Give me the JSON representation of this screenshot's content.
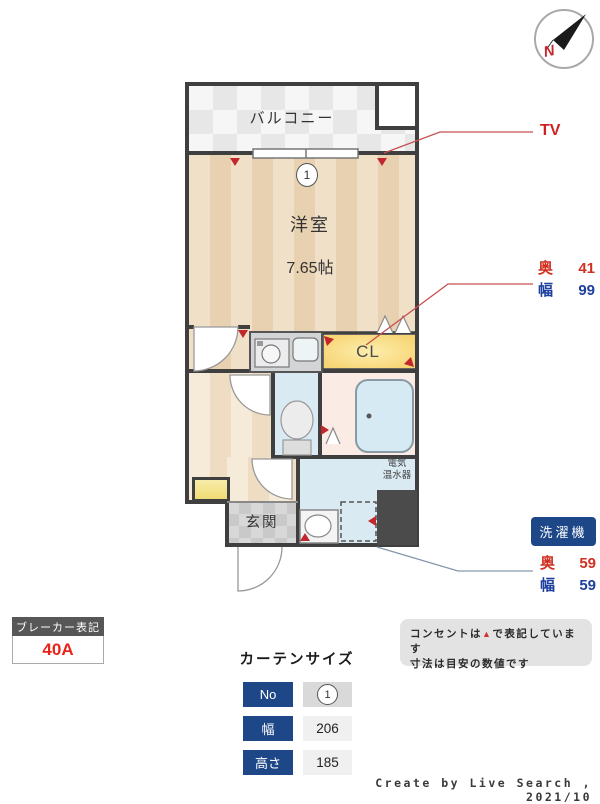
{
  "compass": {
    "north_label": "N"
  },
  "floorplan": {
    "balcony": "バルコニー",
    "room_name": "洋室",
    "room_size": "7.65帖",
    "window_no": "1",
    "closet": "CL",
    "entrance": "玄関",
    "water_heater_line1": "電気",
    "water_heater_line2": "温水器"
  },
  "annotations": {
    "tv": "TV",
    "closet_dims": {
      "rows": [
        {
          "label": "奥",
          "value": "41"
        },
        {
          "label": "幅",
          "value": "99"
        }
      ]
    },
    "washer": {
      "badge": "洗濯機",
      "rows": [
        {
          "label": "奥",
          "value": "59"
        },
        {
          "label": "幅",
          "value": "59"
        }
      ]
    }
  },
  "breaker": {
    "title": "ブレーカー表記",
    "value": "40A"
  },
  "curtain": {
    "title": "カーテンサイズ",
    "rows": [
      {
        "label": "No",
        "value": "1"
      },
      {
        "label": "幅",
        "value": "206"
      },
      {
        "label": "高さ",
        "value": "185"
      }
    ]
  },
  "notes": {
    "line1_pre": "コンセントは",
    "line1_marker": "▲",
    "line1_post": "で表記しています",
    "line2": "寸法は目安の数値です"
  },
  "footer": "Create by Live Search , 2021/10",
  "colors": {
    "accent_red": "#cf2121",
    "accent_blue": "#1d4787",
    "wall": "#3f3f3f",
    "closet_fill": "#f8dd8a",
    "wet_area": "#d9eaf2",
    "bath_floor": "#faece4"
  }
}
